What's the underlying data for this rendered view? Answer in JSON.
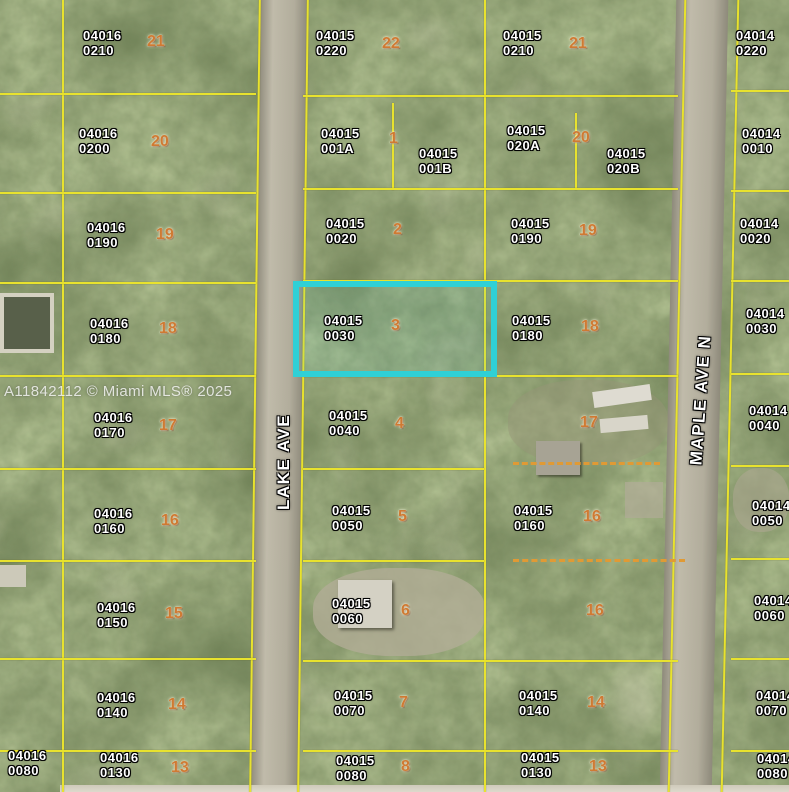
{
  "watermark": "A11842112 © Miami MLS® 2025",
  "streets": [
    {
      "name": "LAKE AVE"
    },
    {
      "name": "MAPLE AVE N"
    }
  ],
  "highlight": {
    "parcel_book": "04015",
    "parcel_page": "0030",
    "color": "#2fd0d6"
  },
  "colors": {
    "boundary": "#e8e22e",
    "easement_dash": "#e09a35",
    "highlight": "#2fd0d6"
  },
  "parcels": [
    {
      "book": "04016",
      "page": "0210"
    },
    {
      "book": "04015",
      "page": "0220"
    },
    {
      "book": "04015",
      "page": "0210"
    },
    {
      "book": "04014",
      "page": "0220"
    },
    {
      "book": "04016",
      "page": "0200"
    },
    {
      "book": "04015",
      "page": "001A"
    },
    {
      "book": "04015",
      "page": "001B"
    },
    {
      "book": "04015",
      "page": "020A"
    },
    {
      "book": "04015",
      "page": "020B"
    },
    {
      "book": "04014",
      "page": "0010"
    },
    {
      "book": "04016",
      "page": "0190"
    },
    {
      "book": "04015",
      "page": "0020"
    },
    {
      "book": "04015",
      "page": "0190"
    },
    {
      "book": "04014",
      "page": "0020"
    },
    {
      "book": "04016",
      "page": "0180"
    },
    {
      "book": "04015",
      "page": "0030"
    },
    {
      "book": "04015",
      "page": "0180"
    },
    {
      "book": "04014",
      "page": "0030"
    },
    {
      "book": "04016",
      "page": "0170"
    },
    {
      "book": "04015",
      "page": "0040"
    },
    {
      "book": "04014",
      "page": "0040"
    },
    {
      "book": "04016",
      "page": "0160"
    },
    {
      "book": "04015",
      "page": "0050"
    },
    {
      "book": "04015",
      "page": "0160"
    },
    {
      "book": "04014",
      "page": "0050"
    },
    {
      "book": "04016",
      "page": "0150"
    },
    {
      "book": "04015",
      "page": "0060"
    },
    {
      "book": "04014",
      "page": "0060"
    },
    {
      "book": "04016",
      "page": "0140"
    },
    {
      "book": "04015",
      "page": "0070"
    },
    {
      "book": "04015",
      "page": "0140"
    },
    {
      "book": "04014",
      "page": "0070"
    },
    {
      "book": "04016",
      "page": "0080"
    },
    {
      "book": "04016",
      "page": "0130"
    },
    {
      "book": "04015",
      "page": "0080"
    },
    {
      "book": "04015",
      "page": "0130"
    },
    {
      "book": "04014",
      "page": "0080"
    }
  ],
  "lots": [
    {
      "n": "21"
    },
    {
      "n": "22"
    },
    {
      "n": "21"
    },
    {
      "n": "20"
    },
    {
      "n": "1"
    },
    {
      "n": "20"
    },
    {
      "n": "19"
    },
    {
      "n": "2"
    },
    {
      "n": "19"
    },
    {
      "n": "18"
    },
    {
      "n": "3"
    },
    {
      "n": "18"
    },
    {
      "n": "17"
    },
    {
      "n": "4"
    },
    {
      "n": "17"
    },
    {
      "n": "16"
    },
    {
      "n": "5"
    },
    {
      "n": "16"
    },
    {
      "n": "15"
    },
    {
      "n": "6"
    },
    {
      "n": "16"
    },
    {
      "n": "14"
    },
    {
      "n": "7"
    },
    {
      "n": "14"
    },
    {
      "n": "13"
    },
    {
      "n": "8"
    },
    {
      "n": "13"
    }
  ]
}
